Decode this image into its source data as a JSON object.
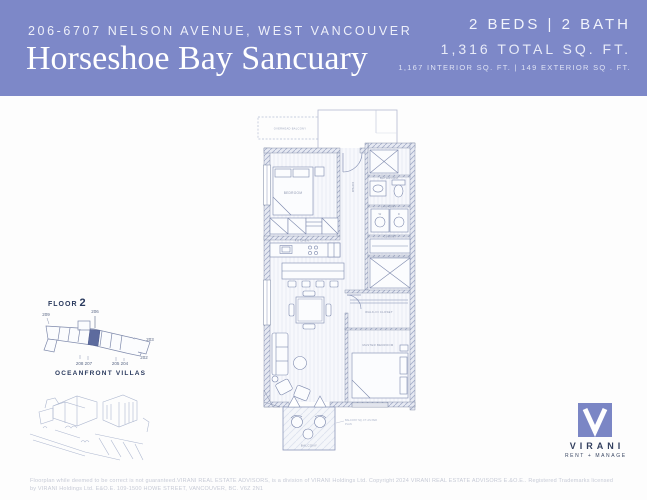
{
  "header": {
    "address": "206-6707 NELSON AVENUE, WEST VANCOUVER",
    "title": "Horseshoe Bay Sancuary",
    "beds_bath": "2 BEDS | 2 BATH",
    "total_sqft": "1,316 TOTAL SQ. FT.",
    "sqft_breakdown": "1,167 INTERIOR SQ. FT. | 149 EXTERIOR SQ . FT."
  },
  "keyplan": {
    "floor_label": "FLOOR",
    "floor_number": "2",
    "unit_top": "206",
    "unit_left": "209",
    "unit_bottom_left": "208 207",
    "unit_bottom_right": "205 204",
    "unit_right_upper": "203",
    "unit_right_lower": "202"
  },
  "villas": {
    "label": "OCEANFRONT VILLAS"
  },
  "floorplan": {
    "labels": {
      "overhead": "OVERHEAD BALCONY",
      "bedroom": "BEDROOM",
      "foyer": "FOYER",
      "bathroom": "BATHROOM",
      "laundry": "LAUNDRY",
      "w": "W",
      "d": "D",
      "closet": "CLOSET",
      "kitchen": "KITCHEN",
      "walkin": "WALK-IN CLOSET",
      "master": "MASTER BEDROOM",
      "balcony": "BALCONY",
      "note1": "BALCONY SQ. FT. AS PER",
      "note2": "PLAN"
    }
  },
  "logo": {
    "v": "V",
    "name": "VIRANI",
    "tagline": "RENT + MANAGE"
  },
  "footer": {
    "line1": "Floorplan while deemed to be correct is not guaranteed.VIRANI REAL ESTATE ADVISORS, is a division of VIRANI Holdings Ltd. Copyright 2024 VIRANI REAL ESTATE ADVISORS E.&O.E.. Registered Trademarks licensed",
    "line2": "by VIRANI Holdings Ltd. E&O.E. 109-1500 HOWE STREET, VANCOUVER, BC. V6Z 2N1"
  }
}
